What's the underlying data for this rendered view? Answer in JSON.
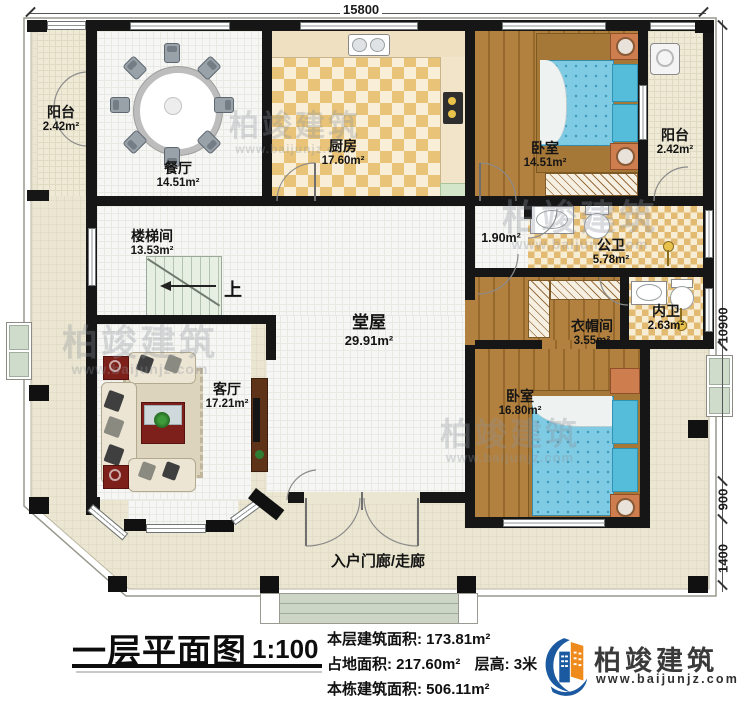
{
  "plan": {
    "dimensions": {
      "width_top": "15800",
      "height_right": "10900",
      "porch_depth": "900",
      "entry_depth": "1400"
    },
    "stairs_up_label": "上",
    "rooms": {
      "balcony_left": {
        "name": "阳台",
        "area": "2.42m²"
      },
      "dining": {
        "name": "餐厅",
        "area": "14.51m²"
      },
      "kitchen": {
        "name": "厨房",
        "area": "17.60m²"
      },
      "bedroom_top": {
        "name": "卧室",
        "area": "14.51m²"
      },
      "balcony_right": {
        "name": "阳台",
        "area": "2.42m²"
      },
      "stair_hall": {
        "name": "楼梯间",
        "area": "13.53m²"
      },
      "hall": {
        "name": "堂屋",
        "area": "29.91m²"
      },
      "vestibule": {
        "area": "1.90m²"
      },
      "public_bath": {
        "name": "公卫",
        "area": "5.78m²"
      },
      "inner_bath": {
        "name": "内卫",
        "area": "2.63m²"
      },
      "cloakroom": {
        "name": "衣帽间",
        "area": "3.55m²"
      },
      "living": {
        "name": "客厅",
        "area": "17.21m²"
      },
      "bedroom_bottom": {
        "name": "卧室",
        "area": "16.80m²"
      },
      "entry_porch": {
        "name": "入户门廊/走廊"
      }
    }
  },
  "watermark": {
    "brand": "柏竣建筑",
    "site": "www.baijunjz.com"
  },
  "footer": {
    "title": "一层平面图",
    "scale": "1:100",
    "stats": {
      "floor_area_label": "本层建筑面积:",
      "floor_area_value": "173.81m²",
      "land_area_label": "占地面积:",
      "land_area_value": "217.60m²",
      "storey_height_label": "层高:",
      "storey_height_value": "3米",
      "total_area_label": "本栋建筑面积:",
      "total_area_value": "506.11m²"
    },
    "logo": {
      "brand": "柏竣建筑",
      "site": "www.baijunjz.com"
    }
  }
}
